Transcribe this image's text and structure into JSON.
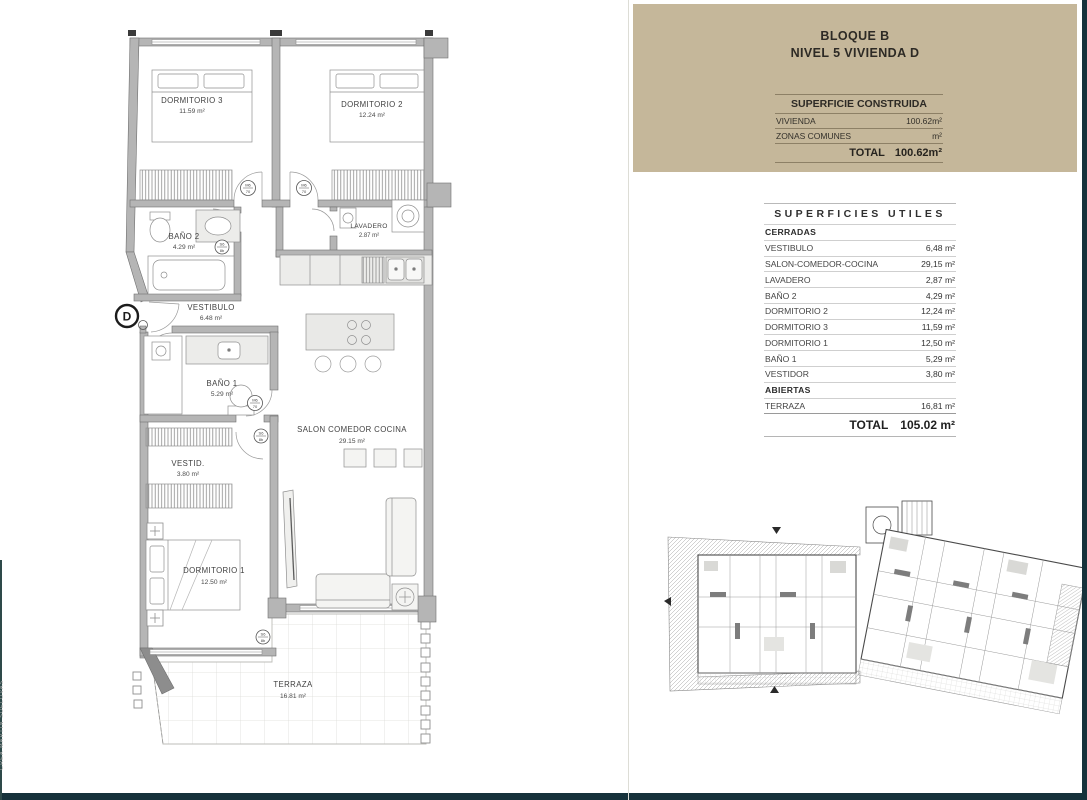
{
  "header": {
    "line1": "BLOQUE B",
    "line2": "NIVEL 5 VIVIENDA D"
  },
  "superficie_construida": {
    "title": "SUPERFICIE CONSTRUIDA",
    "rows": [
      {
        "label": "VIVIENDA",
        "value": "100.62m²"
      },
      {
        "label": "ZONAS COMUNES",
        "value": "m²"
      }
    ],
    "total": {
      "label": "TOTAL",
      "value": "100.62m²"
    }
  },
  "superficies_utiles": {
    "title": "SUPERFICIES UTILES",
    "cerradas_heading": "CERRADAS",
    "cerradas": [
      {
        "label": "VESTIBULO",
        "value": "6,48 m²"
      },
      {
        "label": "SALON-COMEDOR-COCINA",
        "value": "29,15 m²"
      },
      {
        "label": "LAVADERO",
        "value": "2,87 m²"
      },
      {
        "label": "BAÑO 2",
        "value": "4,29 m²"
      },
      {
        "label": "DORMITORIO 2",
        "value": "12,24 m²"
      },
      {
        "label": "DORMITORIO 3",
        "value": "11,59 m²"
      },
      {
        "label": "DORMITORIO 1",
        "value": "12,50 m²"
      },
      {
        "label": "BAÑO 1",
        "value": "5,29 m²"
      },
      {
        "label": "VESTIDOR",
        "value": "3,80 m²"
      }
    ],
    "abiertas_heading": "ABIERTAS",
    "abiertas": [
      {
        "label": "TERRAZA",
        "value": "16,81 m²"
      }
    ],
    "total": {
      "label": "TOTAL",
      "value": "105.02 m²"
    }
  },
  "floorplan": {
    "entrance_label": "D",
    "rooms": {
      "dormitorio3": {
        "name": "DORMITORIO 3",
        "area": "11.59 m²"
      },
      "dormitorio2": {
        "name": "DORMITORIO 2",
        "area": "12.24 m²"
      },
      "bano2": {
        "name": "BAÑO 2",
        "area": "4.29 m²"
      },
      "lavadero": {
        "name": "LAVADERO",
        "area": "2.87 m²"
      },
      "vestibulo": {
        "name": "VESTIBULO",
        "area": "6.48 m²"
      },
      "bano1": {
        "name": "BAÑO 1",
        "area": "5.29 m²"
      },
      "vestidor": {
        "name": "VESTID.",
        "area": "3.80 m²"
      },
      "dormitorio1": {
        "name": "DORMITORIO 1",
        "area": "12.50 m²"
      },
      "salon": {
        "name": "SALON COMEDOR COCINA",
        "area": "29.15 m²"
      },
      "terraza": {
        "name": "TERRAZA",
        "area": "16.81 m²"
      }
    },
    "door_tags": {
      "m_top": "M6",
      "m_bottom": "70",
      "s_top": "S6",
      "s_bottom": "8b"
    }
  },
  "watermark": "CREA MARTIN SUELOVAS",
  "colors": {
    "panel_tan": "#c5b79a",
    "frame_dark": "#16323b",
    "wall_gray": "#b5b5b5"
  }
}
